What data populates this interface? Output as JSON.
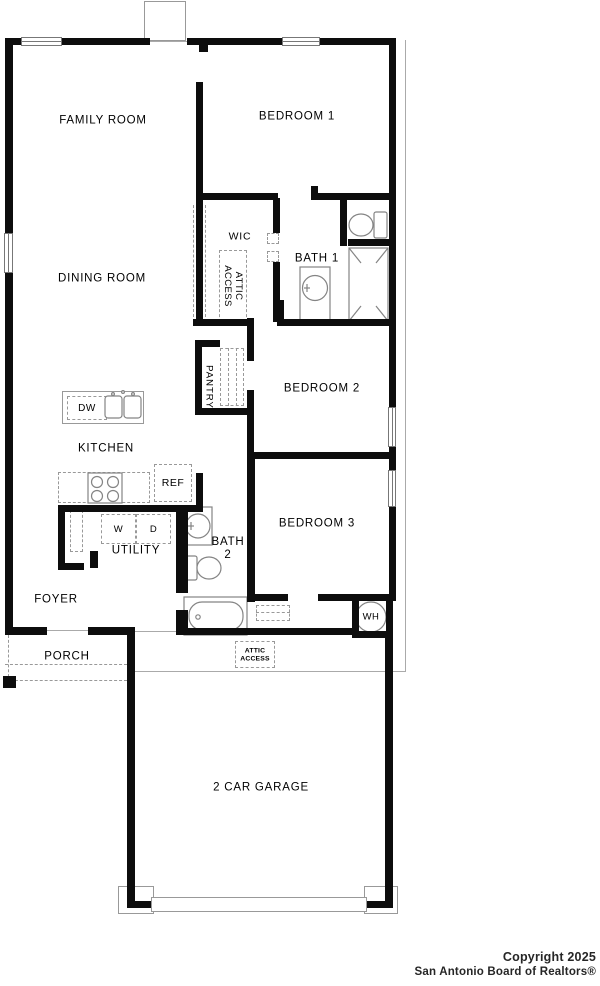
{
  "meta": {
    "type": "residential floor plan"
  },
  "labels": {
    "family_room": "FAMILY ROOM",
    "bedroom_1": "BEDROOM 1",
    "dining_room": "DINING ROOM",
    "wic": "WIC",
    "attic_access_line1": "ATTIC",
    "attic_access_line2": "ACCESS",
    "bath_1": "BATH 1",
    "pantry": "PANTRY",
    "bedroom_2": "BEDROOM 2",
    "kitchen": "KITCHEN",
    "dishwasher": "DW",
    "refrigerator": "REF",
    "washer": "W",
    "dryer": "D",
    "utility": "UTILITY",
    "bath_2_line1": "BATH",
    "bath_2_line2": "2",
    "bedroom_3": "BEDROOM 3",
    "foyer": "FOYER",
    "water_heater": "WH",
    "porch": "PORCH",
    "garage": "2 CAR GARAGE"
  },
  "footer": {
    "copyright_line1": "Copyright 2025",
    "copyright_line2": "San Antonio Board of Realtors®"
  },
  "colors": {
    "wall": "#0d0d0d",
    "fixture_line": "#848484",
    "thin_line": "#aaaaaa",
    "dashed_line": "#999999",
    "background": "#ffffff",
    "text": "#000000"
  }
}
